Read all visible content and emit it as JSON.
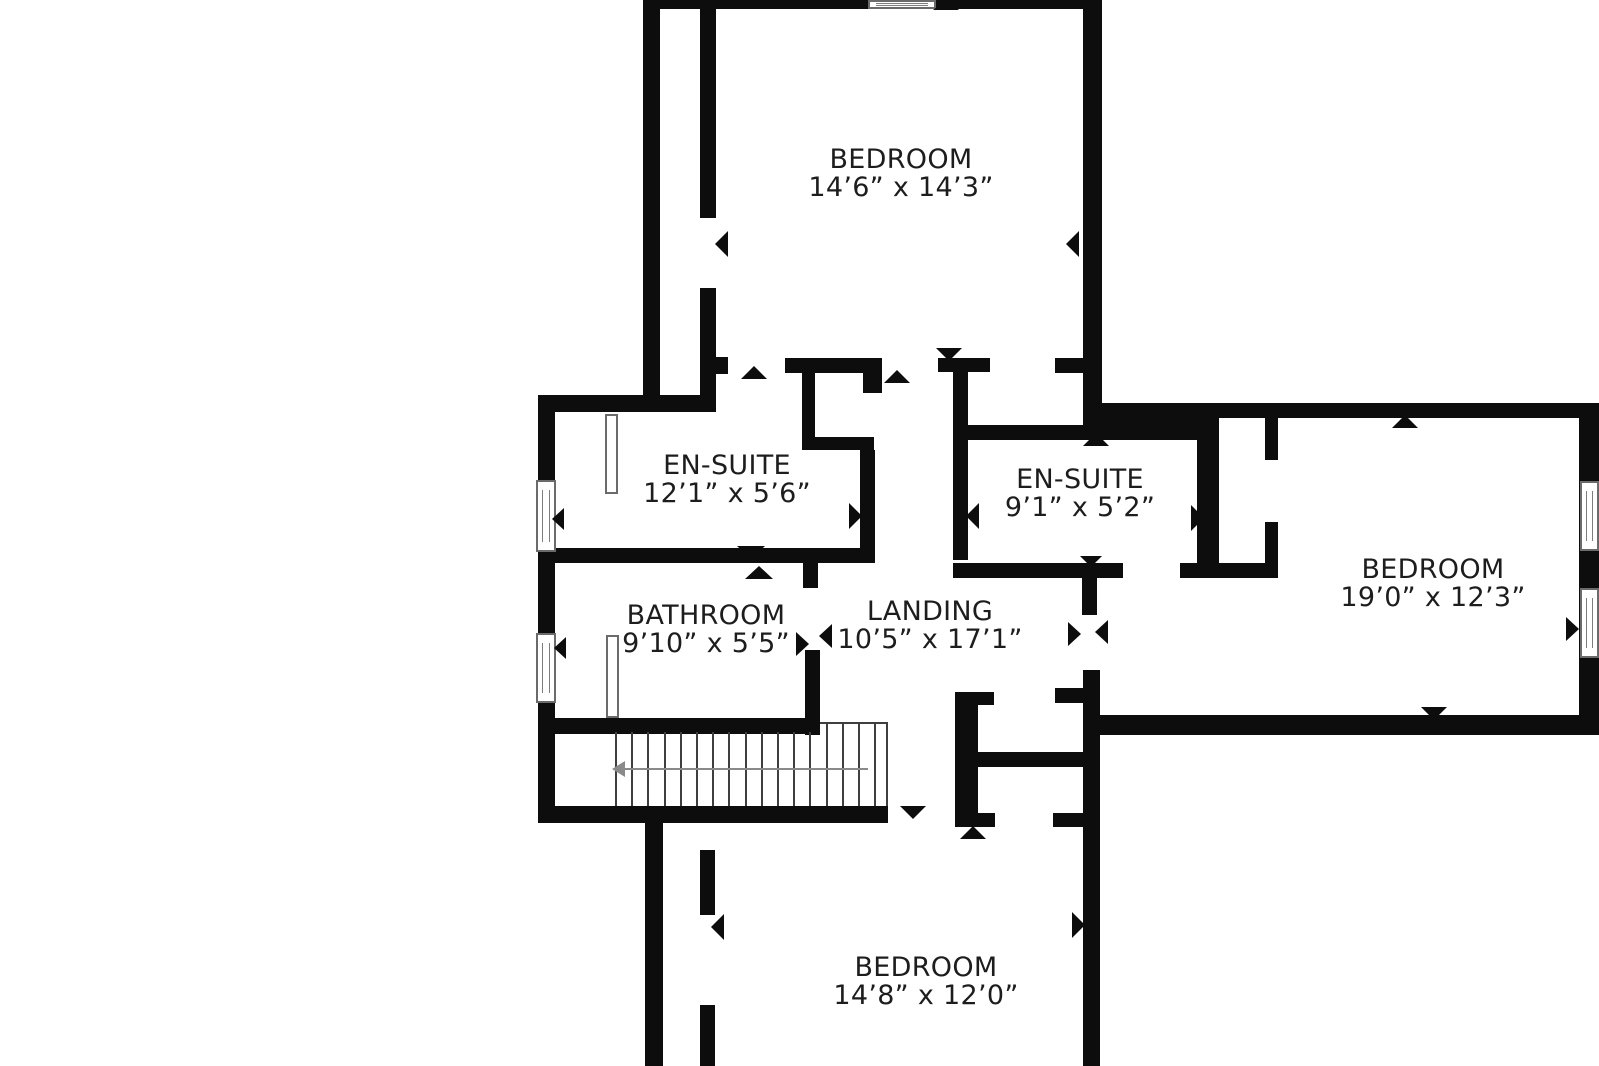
{
  "plan": {
    "type": "floor-plan",
    "rooms": [
      {
        "id": "bedroom-top",
        "name": "BEDROOM",
        "dims": "14’6” x 14’3”"
      },
      {
        "id": "ensuite-left",
        "name": "EN-SUITE",
        "dims": "12’1” x 5’6”"
      },
      {
        "id": "ensuite-right",
        "name": "EN-SUITE",
        "dims": "9’1” x 5’2”"
      },
      {
        "id": "bedroom-right",
        "name": "BEDROOM",
        "dims": "19’0” x 12’3”"
      },
      {
        "id": "bathroom",
        "name": "BATHROOM",
        "dims": "9’10” x 5’5”"
      },
      {
        "id": "landing",
        "name": "LANDING",
        "dims": "10’5” x 17’1”"
      },
      {
        "id": "bedroom-bottom",
        "name": "BEDROOM",
        "dims": "14’8” x 12’0”"
      }
    ],
    "icons": {
      "door_marker": "solid-triangle",
      "stair_arrow": "arrow-left"
    },
    "colors": {
      "wall": "#0d0d0d",
      "background": "#ffffff",
      "text": "#1d1d1d",
      "stair_tread": "#3f3f3f",
      "stair_arrow": "#8a8a8a",
      "fixture_outline": "#6b6b6b"
    }
  }
}
